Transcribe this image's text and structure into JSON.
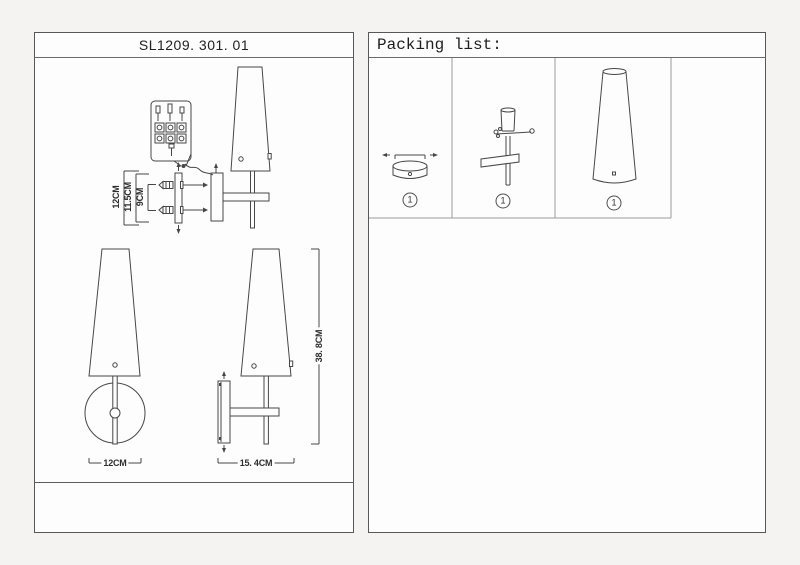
{
  "colors": {
    "page_bg": "#f4f3f1",
    "panel_bg": "#fdfdfd",
    "panel_border": "#585858",
    "grid_line": "#9c9c9c",
    "drawing_line": "#474747"
  },
  "left_panel": {
    "title": "SL1209. 301. 01",
    "dimensions": {
      "mount_total": "12CM",
      "mount_mid": "11.5CM",
      "mount_inner": "9CM",
      "front_width": "12CM",
      "side_depth": "15. 4CM",
      "total_height": "38. 8CM"
    }
  },
  "right_panel": {
    "title": "Packing list:",
    "items": [
      {
        "name": "wall-canopy",
        "qty": "1"
      },
      {
        "name": "bracket-with-stem",
        "qty": "1"
      },
      {
        "name": "cone-shade",
        "qty": "1"
      }
    ]
  }
}
